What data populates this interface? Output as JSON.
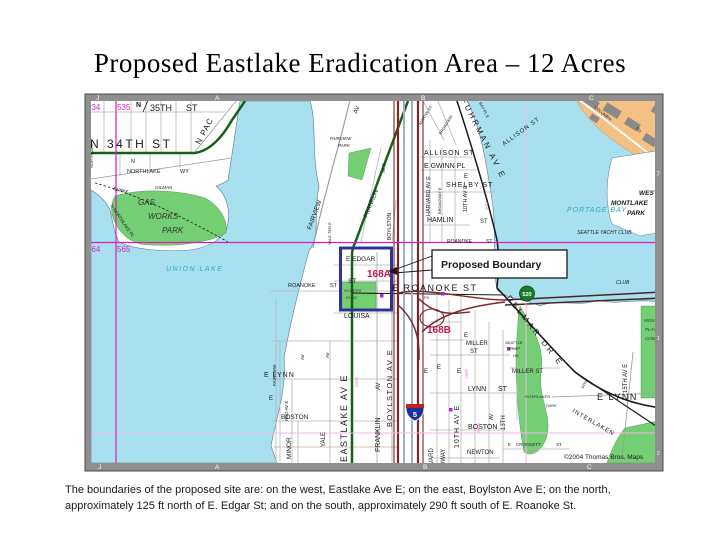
{
  "title": "Proposed Eastlake Eradication Area – 12 Acres",
  "caption": {
    "line1": "The boundaries of the proposed site are:  on the west, Eastlake Ave E; on the east, Boylston Ave E; on the north,",
    "line2": "approximately 125 ft north of E. Edgar St; and on the south, approximately 290 ft south of E. Roanoke St."
  },
  "callout": {
    "label": "Proposed Boundary"
  },
  "map": {
    "copyright": "©2004 Thomas Bros. Maps",
    "colors": {
      "water": "#a8e0ef",
      "park": "#74ce74",
      "land": "#ffffff",
      "water_text": "#2aa8c8",
      "magenta": "#dd1cb8",
      "pink": "#e88fd8",
      "red": "#cc1144",
      "green_road": "#176117",
      "maroon": "#7b2828",
      "slate": "#9cb2c8",
      "orange": "#f5c083",
      "building": "#8a8a8a",
      "frame": "#8f8f8f",
      "white": "#ffffff",
      "navy": "#2e3494",
      "black": "#1a1a1a",
      "gray_road": "#b5b5b5",
      "shield_blue": "#1d2f9e",
      "shield_green": "#1c7a2a",
      "purple": "#b322d6",
      "dark": "#333333"
    },
    "labels": [
      {
        "t": "534",
        "x": 87,
        "y": 110,
        "s": 8,
        "c": "magenta"
      },
      {
        "t": "535",
        "x": 117,
        "y": 110,
        "s": 8,
        "c": "magenta"
      },
      {
        "t": "564",
        "x": 87,
        "y": 252,
        "s": 8,
        "c": "magenta"
      },
      {
        "t": "565",
        "x": 117,
        "y": 252,
        "s": 8,
        "c": "magenta"
      },
      {
        "t": "35TH",
        "x": 150,
        "y": 111,
        "s": 9
      },
      {
        "t": "ST",
        "x": 186,
        "y": 111,
        "s": 9
      },
      {
        "t": "N",
        "x": 136,
        "y": 107,
        "s": 7,
        "b": 1
      },
      {
        "t": "N 34TH ST",
        "x": 90,
        "y": 148,
        "s": 12,
        "sp": 2.5
      },
      {
        "t": "N PAC",
        "x": 200,
        "y": 145,
        "s": 8,
        "r": -62,
        "sp": 1
      },
      {
        "t": "NORTHLAKE",
        "x": 93,
        "y": 168,
        "s": 4,
        "r": -90
      },
      {
        "t": "N",
        "x": 131,
        "y": 163,
        "s": 5.5
      },
      {
        "t": "NORTHLAKE",
        "x": 127,
        "y": 173,
        "s": 5.5
      },
      {
        "t": "WY",
        "x": 180,
        "y": 173,
        "s": 5.5
      },
      {
        "t": "BURKE",
        "x": 113,
        "y": 190,
        "s": 4.5,
        "it": 1,
        "r": 14
      },
      {
        "t": "GILMAN",
        "x": 155,
        "y": 189,
        "s": 4.5,
        "it": 1
      },
      {
        "t": "GAS",
        "x": 138,
        "y": 205,
        "s": 8,
        "it": 1,
        "c": "dark"
      },
      {
        "t": "WORKS",
        "x": 148,
        "y": 219,
        "s": 8,
        "it": 1,
        "c": "dark"
      },
      {
        "t": "PARK",
        "x": 162,
        "y": 233,
        "s": 8,
        "it": 1,
        "c": "dark"
      },
      {
        "t": "N NORTHLAKE PL",
        "x": 110,
        "y": 206,
        "s": 4.5,
        "r": 55
      },
      {
        "t": "UNION  LAKE",
        "x": 166,
        "y": 271,
        "s": 7,
        "c": "water_text",
        "it": 1,
        "sp": 1.5
      },
      {
        "t": "FAIRVIEW",
        "x": 330,
        "y": 140,
        "s": 4.5,
        "it": 1
      },
      {
        "t": "PARK",
        "x": 338,
        "y": 147,
        "s": 4.5,
        "it": 1
      },
      {
        "t": "FAIRVIEW",
        "x": 311,
        "y": 230,
        "s": 6.5,
        "r": -70
      },
      {
        "t": "AV",
        "x": 357,
        "y": 114,
        "s": 6,
        "r": -70
      },
      {
        "t": "FRANKLIN",
        "x": 367,
        "y": 218,
        "s": 6,
        "r": -68
      },
      {
        "t": "AV E",
        "x": 385,
        "y": 173,
        "s": 4.5,
        "r": -90
      },
      {
        "t": "YALE TER E",
        "x": 331,
        "y": 245,
        "s": 4,
        "r": -90
      },
      {
        "t": "BOYLSTON",
        "x": 391,
        "y": 240,
        "s": 5,
        "r": -90
      },
      {
        "t": "E  EDGAR",
        "x": 346,
        "y": 261,
        "s": 6.5
      },
      {
        "t": "ST",
        "x": 348,
        "y": 283,
        "s": 6.5
      },
      {
        "t": "168A",
        "x": 367,
        "y": 277,
        "s": 10,
        "c": "red",
        "b": 1
      },
      {
        "t": "ROGERS",
        "x": 344,
        "y": 292,
        "s": 4,
        "it": 1,
        "c": "dark"
      },
      {
        "t": "PLGD",
        "x": 346,
        "y": 299,
        "s": 4,
        "it": 1,
        "c": "dark"
      },
      {
        "t": "LOUISA",
        "x": 344,
        "y": 318,
        "s": 7
      },
      {
        "t": "ROANOKE",
        "x": 288,
        "y": 287,
        "s": 5.5
      },
      {
        "t": "ST",
        "x": 330,
        "y": 287,
        "s": 5.5
      },
      {
        "t": "E LYNN",
        "x": 264,
        "y": 377,
        "s": 7,
        "sp": 1
      },
      {
        "t": "BOSTON",
        "x": 281,
        "y": 419,
        "s": 6.5
      },
      {
        "t": "MINOR",
        "x": 291,
        "y": 459,
        "s": 6.5,
        "r": -90
      },
      {
        "t": "YALE",
        "x": 325,
        "y": 447,
        "s": 6,
        "r": -90
      },
      {
        "t": "FAIRVIEW",
        "x": 276,
        "y": 386,
        "s": 4.5,
        "r": -90
      },
      {
        "t": "E",
        "x": 269,
        "y": 400,
        "s": 6
      },
      {
        "t": "RED AV E",
        "x": 288,
        "y": 421,
        "s": 4.5,
        "r": -90
      },
      {
        "t": "AV",
        "x": 304,
        "y": 360,
        "s": 4.5,
        "r": -90
      },
      {
        "t": "AV",
        "x": 329,
        "y": 358,
        "s": 4.5,
        "r": -90
      },
      {
        "t": "2500",
        "x": 358,
        "y": 387,
        "s": 4.5,
        "c": "pink",
        "r": -90
      },
      {
        "t": "EASTLAKE  AV  E",
        "x": 347,
        "y": 462,
        "s": 9,
        "r": -90,
        "sp": 1.5
      },
      {
        "t": "FRANKLIN",
        "x": 380,
        "y": 452,
        "s": 7,
        "r": -90
      },
      {
        "t": "AV",
        "x": 380,
        "y": 390,
        "s": 6,
        "r": -90
      },
      {
        "t": "BOYLSTON  AV  E",
        "x": 392,
        "y": 427,
        "s": 7.5,
        "r": -90,
        "sp": 1.5
      },
      {
        "t": "ALLISON  ST",
        "x": 424,
        "y": 155,
        "s": 7,
        "sp": 1
      },
      {
        "t": "E GWINN PL",
        "x": 424,
        "y": 168,
        "s": 7
      },
      {
        "t": "E",
        "x": 464,
        "y": 178,
        "s": 6
      },
      {
        "t": "SHELBY  ST",
        "x": 446,
        "y": 187,
        "s": 7,
        "sp": 1
      },
      {
        "t": "HAMLIN",
        "x": 427,
        "y": 222,
        "s": 7
      },
      {
        "t": "ST",
        "x": 480,
        "y": 223,
        "s": 6
      },
      {
        "t": "HARVARD AV E",
        "x": 430,
        "y": 216,
        "s": 5.5,
        "r": -90
      },
      {
        "t": "BROADWAY E",
        "x": 441,
        "y": 214,
        "s": 4,
        "r": -90
      },
      {
        "t": "10TH AV E",
        "x": 467,
        "y": 212,
        "s": 5.5,
        "r": -90
      },
      {
        "t": "MARTIN ST",
        "x": 421,
        "y": 125,
        "s": 4,
        "r": -58
      },
      {
        "t": "BROADWAY",
        "x": 441,
        "y": 135,
        "s": 4,
        "r": -58
      },
      {
        "t": "FUHRMAN  AV  E",
        "x": 461,
        "y": 100,
        "s": 8,
        "r": 63,
        "sp": 2.5
      },
      {
        "t": "BAY PL E",
        "x": 479,
        "y": 103,
        "s": 4,
        "r": 63
      },
      {
        "t": "ALLISON  ST",
        "x": 504,
        "y": 146,
        "s": 6,
        "r": -36,
        "sp": 1
      },
      {
        "t": "PORTAGE  BAY",
        "x": 567,
        "y": 212,
        "s": 7,
        "c": "water_text",
        "it": 1,
        "sp": 1
      },
      {
        "t": "SEATTLE YACHT CLUB",
        "x": 577,
        "y": 234,
        "s": 5,
        "it": 1
      },
      {
        "t": "WEST",
        "x": 639,
        "y": 195,
        "s": 6.5,
        "it": 1,
        "b": 1
      },
      {
        "t": "MONTLAKE",
        "x": 611,
        "y": 205,
        "s": 6.5,
        "it": 1,
        "b": 1
      },
      {
        "t": "PARK",
        "x": 627,
        "y": 215,
        "s": 6.5,
        "it": 1,
        "b": 1
      },
      {
        "t": "CLUB",
        "x": 616,
        "y": 284,
        "s": 5,
        "it": 1
      },
      {
        "t": "COLUMBIA",
        "x": 594,
        "y": 108,
        "s": 4,
        "r": 38
      },
      {
        "t": "RD",
        "x": 636,
        "y": 128,
        "s": 4,
        "r": 58
      },
      {
        "t": "MONTLAKE",
        "x": 644,
        "y": 322,
        "s": 4.5,
        "it": 1,
        "c": "dark"
      },
      {
        "t": "PLAYFIELD",
        "x": 645,
        "y": 331,
        "s": 4.5,
        "it": 1,
        "c": "dark"
      },
      {
        "t": "COMM CTR",
        "x": 645,
        "y": 340,
        "s": 4.5,
        "it": 1,
        "c": "dark"
      },
      {
        "t": "E  ROANOKE  ST",
        "x": 392,
        "y": 291,
        "s": 9,
        "sp": 1.5
      },
      {
        "t": "ROANOKE",
        "x": 447,
        "y": 243,
        "s": 5
      },
      {
        "t": "ST",
        "x": 486,
        "y": 243,
        "s": 5
      },
      {
        "t": "DELMAR  DR  E",
        "x": 506,
        "y": 298,
        "s": 8,
        "r": 52,
        "sp": 3
      },
      {
        "t": "168B",
        "x": 427,
        "y": 333,
        "s": 10,
        "c": "red",
        "b": 1
      },
      {
        "t": "FS",
        "x": 424,
        "y": 299,
        "s": 3.8
      },
      {
        "t": "SEATTLE",
        "x": 505,
        "y": 344,
        "s": 4,
        "it": 1
      },
      {
        "t": "PREP",
        "x": 509,
        "y": 350,
        "s": 4,
        "it": 1
      },
      {
        "t": "HS",
        "x": 513,
        "y": 357,
        "s": 4,
        "it": 1
      },
      {
        "t": "E",
        "x": 464,
        "y": 337,
        "s": 6
      },
      {
        "t": "MILLER",
        "x": 466,
        "y": 345,
        "s": 6
      },
      {
        "t": "ST",
        "x": 470,
        "y": 353,
        "s": 6
      },
      {
        "t": "MILLER  ST",
        "x": 512,
        "y": 373,
        "s": 6
      },
      {
        "t": "E",
        "x": 457,
        "y": 373,
        "s": 6
      },
      {
        "t": "LYNN",
        "x": 468,
        "y": 391,
        "s": 7
      },
      {
        "t": "ST",
        "x": 498,
        "y": 391,
        "s": 7
      },
      {
        "t": "BOSTON",
        "x": 468,
        "y": 429,
        "s": 7
      },
      {
        "t": "NEWTON",
        "x": 467,
        "y": 454,
        "s": 6
      },
      {
        "t": "E",
        "x": 508,
        "y": 446,
        "s": 4.5
      },
      {
        "t": "CROCKETT",
        "x": 516,
        "y": 446,
        "s": 4.5
      },
      {
        "t": "ST",
        "x": 556,
        "y": 446,
        "s": 4.5
      },
      {
        "t": "INTERLAKEN",
        "x": 525,
        "y": 398,
        "s": 4,
        "it": 1,
        "c": "dark"
      },
      {
        "t": "PARK",
        "x": 546,
        "y": 407,
        "s": 4,
        "it": 1,
        "c": "dark"
      },
      {
        "t": "E  LYNN",
        "x": 597,
        "y": 400,
        "s": 9,
        "sp": 1.5
      },
      {
        "t": "INTERLAKEN",
        "x": 572,
        "y": 412,
        "s": 6,
        "r": 30,
        "sp": 1
      },
      {
        "t": "HARVARD",
        "x": 433,
        "y": 477,
        "s": 6,
        "r": -90
      },
      {
        "t": "BROADWAY",
        "x": 445,
        "y": 483,
        "s": 6,
        "r": -90
      },
      {
        "t": "10TH  AV  E",
        "x": 459,
        "y": 448,
        "s": 7,
        "r": -90,
        "sp": 1
      },
      {
        "t": "13TH",
        "x": 505,
        "y": 430,
        "s": 6,
        "r": -90
      },
      {
        "t": "AV",
        "x": 493,
        "y": 420,
        "s": 5,
        "r": -90
      },
      {
        "t": "E",
        "x": 424,
        "y": 373,
        "s": 6
      },
      {
        "t": "E",
        "x": 437,
        "y": 369,
        "s": 6
      },
      {
        "t": "14TH",
        "x": 583,
        "y": 389,
        "s": 4,
        "r": -58
      },
      {
        "t": "15TH  AV  E",
        "x": 627,
        "y": 393,
        "s": 6,
        "r": -90
      },
      {
        "t": "2800",
        "x": 468,
        "y": 379,
        "s": 4.5,
        "c": "pink",
        "r": -90
      },
      {
        "t": "2900",
        "x": 480,
        "y": 433,
        "s": 4.5,
        "c": "pink",
        "r": -90
      },
      {
        "t": "300",
        "x": 488,
        "y": 210,
        "s": 4.5,
        "c": "pink",
        "r": -90
      },
      {
        "t": "©2004 Thomas Bros. Maps",
        "x": 564,
        "y": 459,
        "s": 6.5
      },
      {
        "t": "520",
        "x": 527,
        "y": 296,
        "s": 5.5,
        "c": "white",
        "b": 1,
        "a": "middle"
      },
      {
        "t": "5",
        "x": 415,
        "y": 417,
        "s": 7.5,
        "c": "white",
        "b": 1,
        "a": "middle"
      }
    ],
    "frame_labels": [
      {
        "t": "J",
        "x": 96,
        "y": 100,
        "s": 6.5,
        "c": "white"
      },
      {
        "t": "A",
        "x": 215,
        "y": 100,
        "s": 6.5,
        "c": "white"
      },
      {
        "t": "B",
        "x": 421,
        "y": 100,
        "s": 6.5,
        "c": "white"
      },
      {
        "t": "C",
        "x": 589,
        "y": 100,
        "s": 6.5,
        "c": "white"
      },
      {
        "t": "J",
        "x": 98,
        "y": 469,
        "s": 6.5,
        "c": "white"
      },
      {
        "t": "A",
        "x": 215,
        "y": 469,
        "s": 6.5,
        "c": "white"
      },
      {
        "t": "B",
        "x": 423,
        "y": 469,
        "s": 6.5,
        "c": "white"
      },
      {
        "t": "C",
        "x": 587,
        "y": 469,
        "s": 6.5,
        "c": "white"
      },
      {
        "t": "7",
        "x": 656.5,
        "y": 176,
        "s": 6,
        "c": "white"
      },
      {
        "t": "1",
        "x": 657,
        "y": 340,
        "s": 5,
        "c": "white"
      },
      {
        "t": "2",
        "x": 657,
        "y": 455,
        "s": 5,
        "c": "white"
      }
    ]
  }
}
